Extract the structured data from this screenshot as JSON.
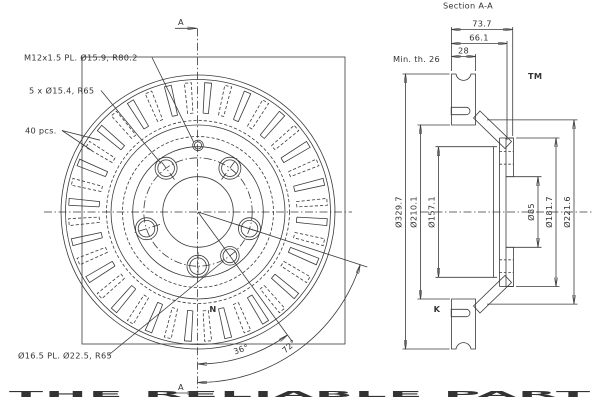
{
  "colors": {
    "line": "#3a3a3a",
    "watermark": "#dcdcdc",
    "background": "#ffffff"
  },
  "watermark": {
    "letter_n": "N",
    "letter_k": "K",
    "tm": "TM",
    "banner": "THE RELIABLE PART"
  },
  "front_view": {
    "notes": {
      "thread": "M12x1.5 PL. Ø15.9, R80.2",
      "bolt_holes": "5 x Ø15.4, R65",
      "vane_count": "40 pcs.",
      "locating_hole": "Ø16.5 PL. Ø22.5, R65"
    },
    "angles": {
      "a36": "36°",
      "a72": "72°"
    },
    "section_marker": "A",
    "geometry": {
      "vane_count": 40,
      "bolt_hole_count": 5
    }
  },
  "section_view": {
    "title": "Section A-A",
    "dims": {
      "overall_width": "73.7",
      "inner_width": "66.1",
      "thickness": "28",
      "min_thickness_note": "Min. th. 26",
      "dia_outer": "Ø329.7",
      "dia_friction_inner": "Ø210.1",
      "dia_drum_inner": "Ø157.1",
      "dia_bore": "Ø85",
      "dia_flange": "Ø181.7",
      "dia_hat": "Ø221.6"
    }
  }
}
